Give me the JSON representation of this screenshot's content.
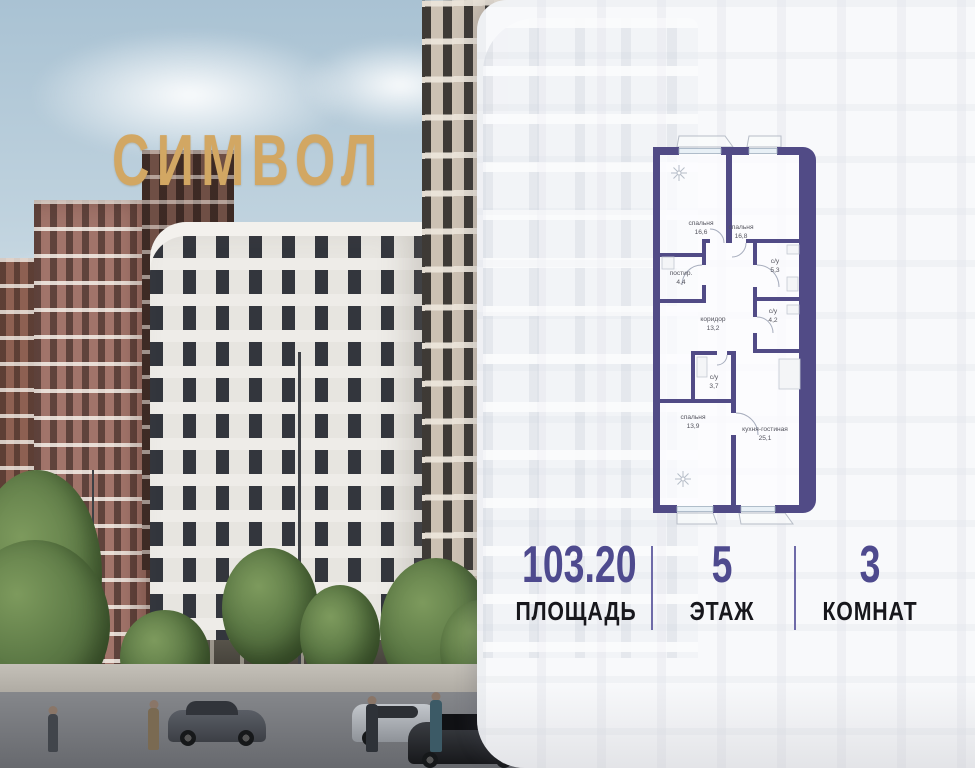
{
  "brand": {
    "logo_text": "СИМВОЛ",
    "logo_color": "#d2a763"
  },
  "panel": {
    "accent_color": "#4e4a8e",
    "floor_plan": {
      "wall_color": "#514b86",
      "rooms": [
        {
          "name": "спальня",
          "area": "16,6"
        },
        {
          "name": "спальня",
          "area": "16,8"
        },
        {
          "name": "постир.",
          "area": "4,4"
        },
        {
          "name": "с/у",
          "area": "5,3"
        },
        {
          "name": "с/у",
          "area": "4,2"
        },
        {
          "name": "коридор",
          "area": "13,2"
        },
        {
          "name": "с/у",
          "area": "3,7"
        },
        {
          "name": "спальня",
          "area": "13,9"
        },
        {
          "name": "кухня-гостиная",
          "area": "25,1"
        }
      ]
    },
    "stats": [
      {
        "value": "103.20",
        "label": "ПЛОЩАДЬ"
      },
      {
        "value": "5",
        "label": "ЭТАЖ"
      },
      {
        "value": "3",
        "label": "КОМНАТ"
      }
    ]
  }
}
